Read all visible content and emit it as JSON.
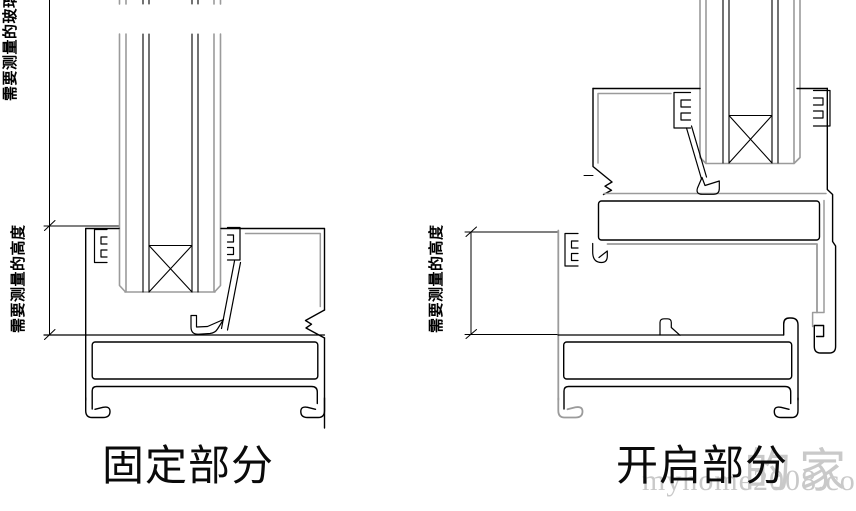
{
  "drawings": {
    "fixed": {
      "caption": "固定部分",
      "dim_glass_label": "需要测量的玻璃",
      "dim_height_label": "需要测量的高度"
    },
    "opening": {
      "caption": "开启部分",
      "dim_height_label": "需要测量的高度"
    }
  },
  "watermark": {
    "cjk_text": "的家",
    "site_text": "myhome2008.com",
    "color": "#c9c9c9"
  },
  "colors": {
    "background": "#ffffff",
    "line": "#000000",
    "light_line": "#9b9b9b"
  }
}
